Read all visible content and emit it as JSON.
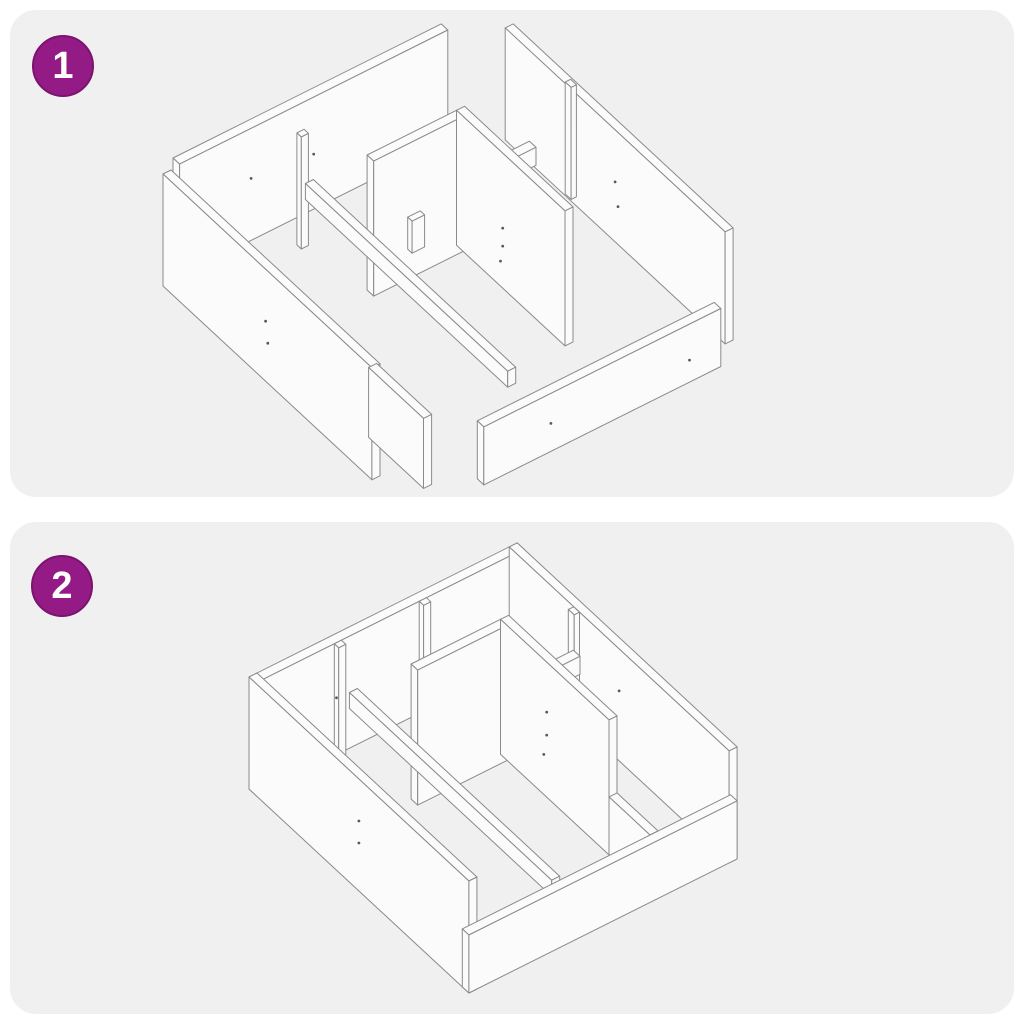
{
  "sheet": {
    "type": "assembly-instructions",
    "step_count": 2
  },
  "panels": [
    {
      "step_label": "1",
      "illustration": "exploded-parts-isometric-view"
    },
    {
      "step_label": "2",
      "illustration": "assembled-frame-isometric-view"
    }
  ],
  "colors": {
    "badge_bg": "#941b86",
    "badge_border": "#7a146e",
    "badge_text": "#ffffff",
    "panel_bg": "#f0f0f0",
    "line": "#8a8a8a",
    "face": "#fbfbfb",
    "dot": "#595959",
    "page_bg": "#ffffff"
  }
}
